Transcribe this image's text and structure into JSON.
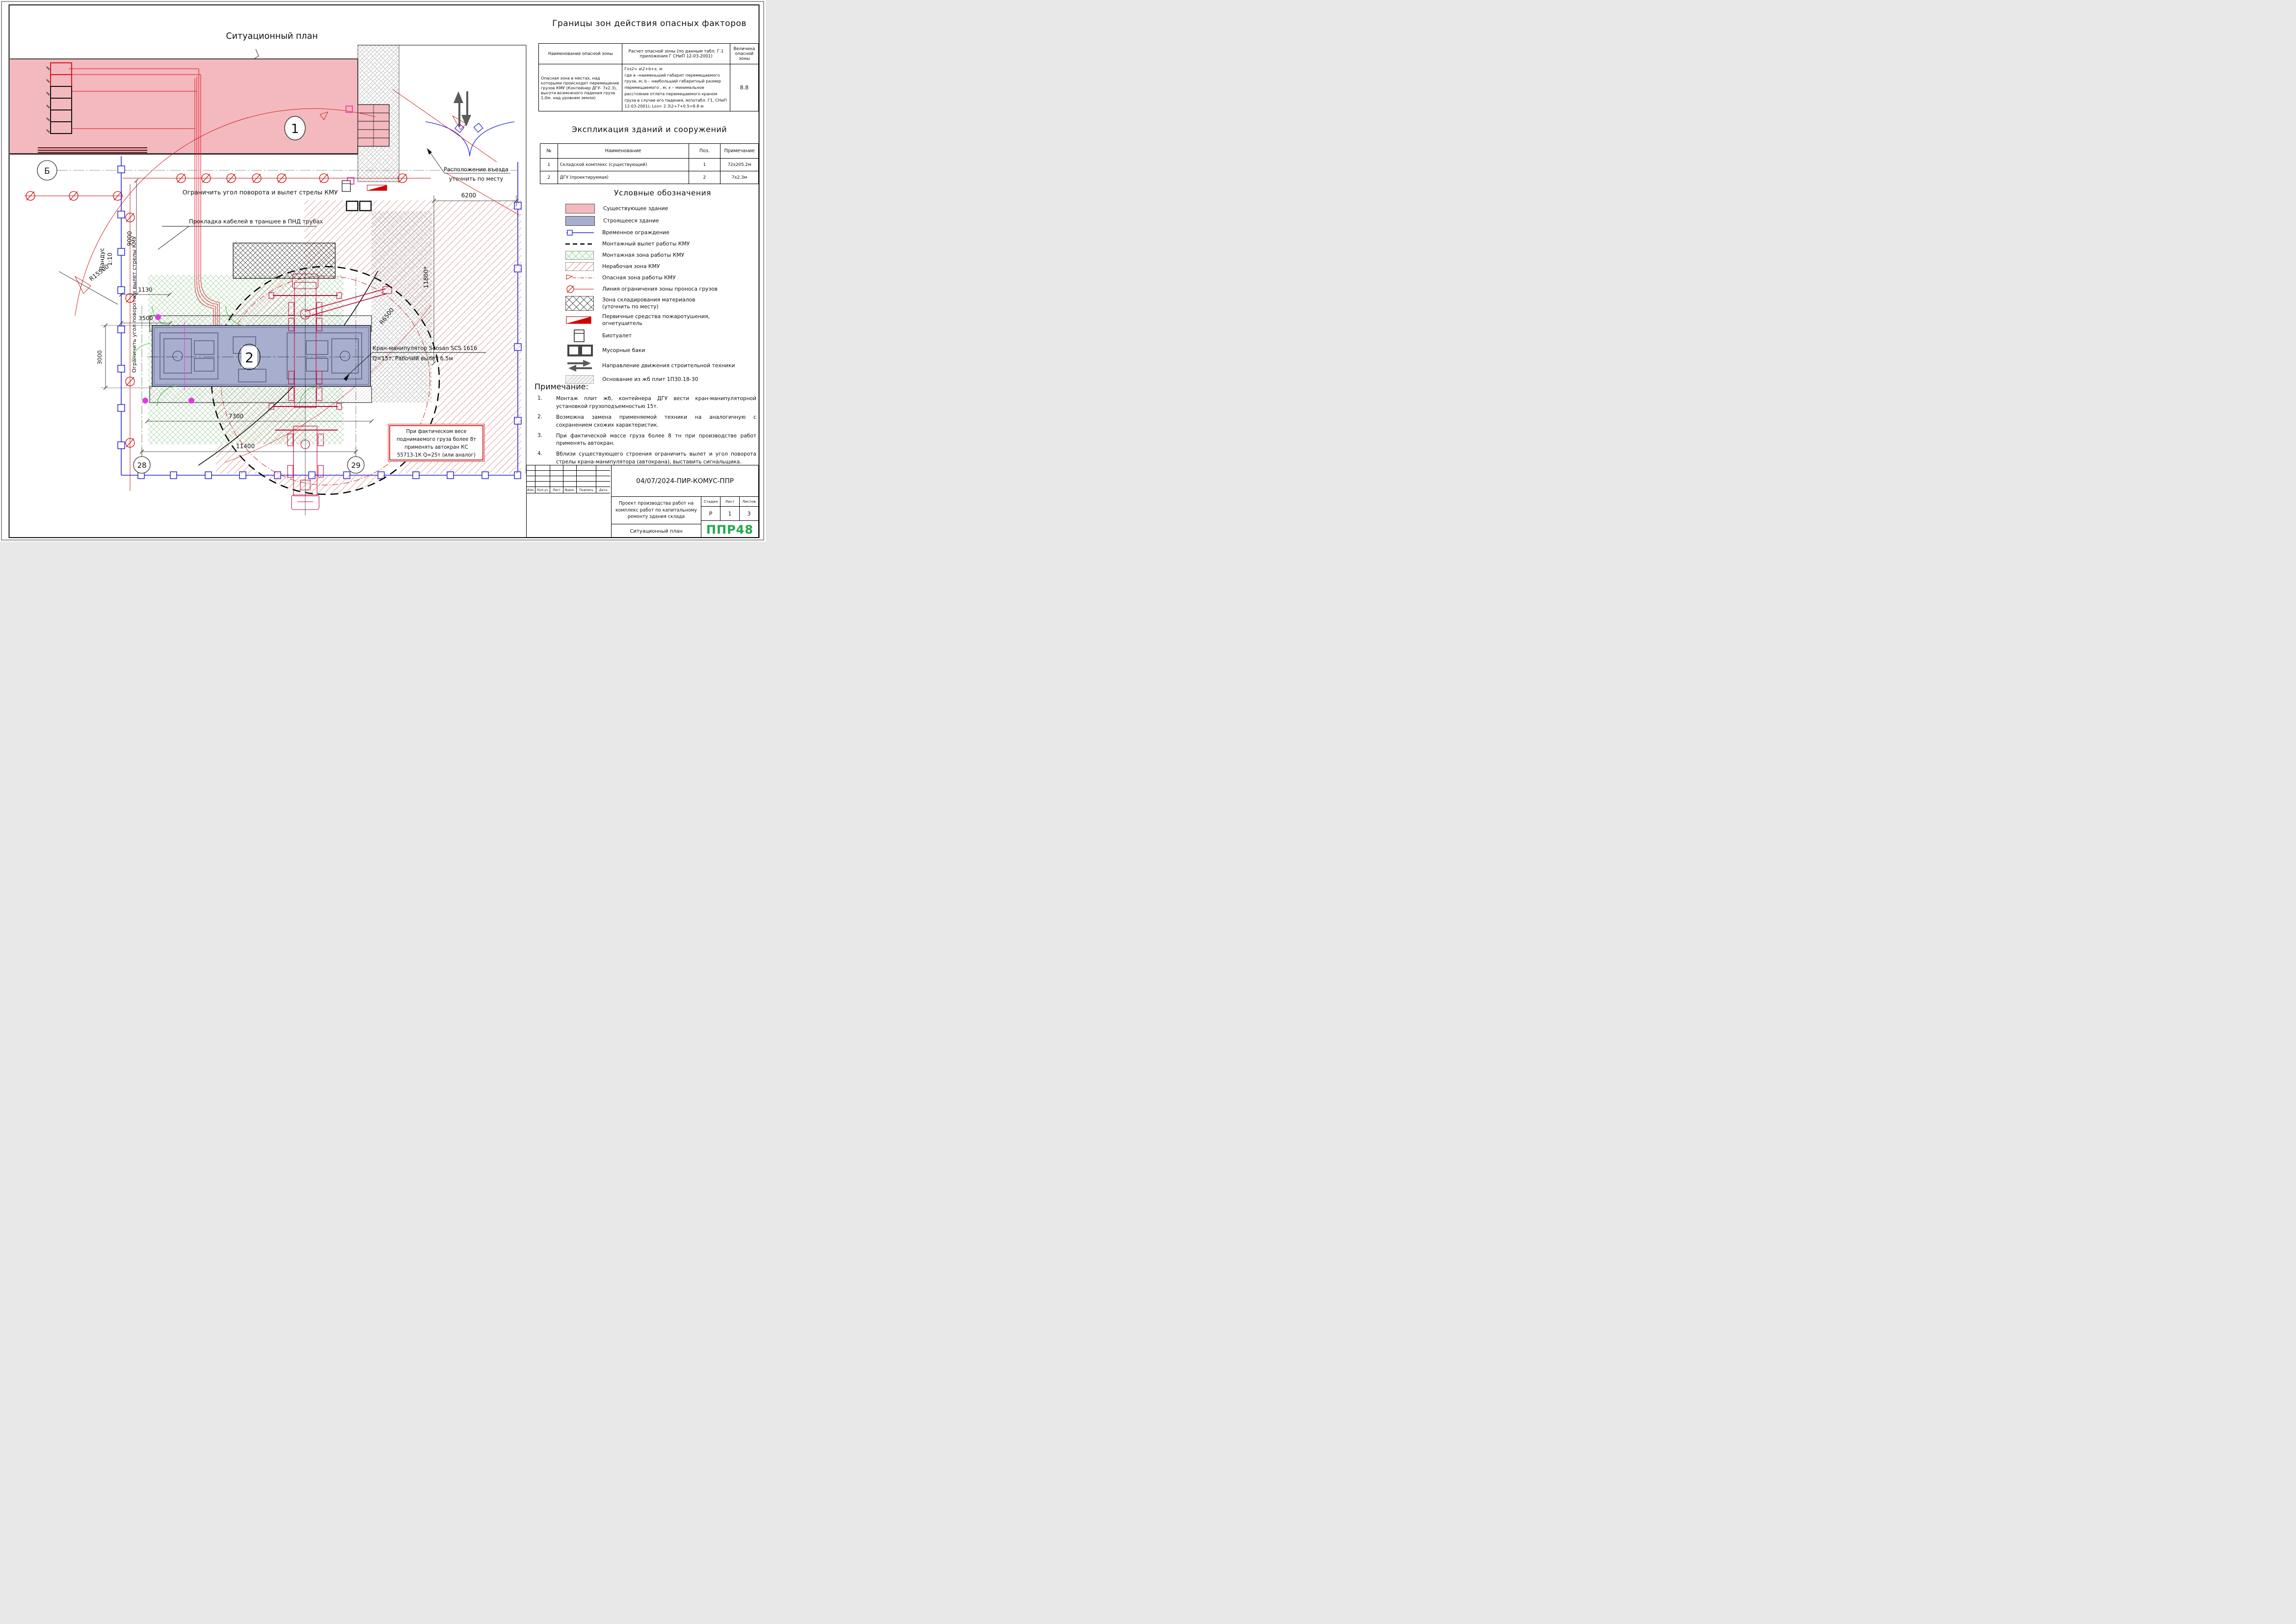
{
  "plan": {
    "title": "Ситуационный план",
    "labels": {
      "limit_red": "Ограничить угол поворота и вылет стрелы КМУ",
      "cable": "Прокладка кабелей в траншее в ПНД трубах",
      "entrance_line1": "Расположение въезда",
      "entrance_line2": "уточнить по месту",
      "crane_name": "Кран-манипулятор Soosan SCS 1616",
      "crane_spec": "Q=15т. Рабочий вылет 6.5м",
      "ramp_line1": "Пандус",
      "ramp_line2": "1:10"
    },
    "warning_box": {
      "lines": [
        "При    фактическом    весе",
        "поднимаемого груза более 8т",
        "применять   автокран   КС",
        "55713-1К Q=25т (или аналог)"
      ]
    },
    "dims": {
      "d6200": "6200",
      "d9000": "9000",
      "d1130": "1130",
      "d3500": "3500",
      "d3000": "3000",
      "d7300": "7300",
      "d11400": "11400",
      "d11800": "11800*",
      "r15500": "R15500",
      "r6500": "R6500"
    },
    "axes": {
      "axis_b": "Б",
      "axis_28": "28",
      "axis_29": "29"
    },
    "positions": {
      "pos1": "1",
      "pos2": "2"
    }
  },
  "hazard_table": {
    "title": "Границы зон действия опасных факторов",
    "headers": [
      "Наименование опасной зоны",
      "Расчет опасной зоны (по данным табл. Г.1 приложения Г СНиП 12-03-2001)",
      "Величина опасной зоны"
    ],
    "row": {
      "name": "Опасная зона в местах, над которыми происходит перемещение грузов КМУ (Контейнер ДГУ- 7х2.3), высота возможного падения груза 1,0м. над уровнем земли)",
      "calc": "Гоз2= а\\2+b+х, м\nгде а –наименьший габарит перемещаемого груза, м; b – наибольший габаритный размер перемещаемого , м; х – минимальное расстояние отлета перемещаемого краном груза в случае его падения, м(потабл. Г1, СНиП 12-03-2001); Lоз= 2.3\\2+7+0.5=8.8 м",
      "value": "8.8"
    }
  },
  "explication_table": {
    "title": "Экспликация зданий и сооружений",
    "headers": [
      "№",
      "Наименование",
      "Поз.",
      "Примечание"
    ],
    "rows": [
      [
        "1",
        "Складской комплекс (существующий)",
        "1",
        "72х205.2м"
      ],
      [
        "2",
        "ДГУ (проектируемая)",
        "2",
        "7х2.3м"
      ]
    ]
  },
  "legend": {
    "title": "Условные обозначения",
    "items": [
      {
        "label": "Существующее здание"
      },
      {
        "label": "Строящееся здание"
      },
      {
        "label": "Временное ограждение"
      },
      {
        "label": "Монтажный вылет работы КМУ"
      },
      {
        "label": "Монтажная зона работы КМУ"
      },
      {
        "label": "Нерабочая зона КМУ"
      },
      {
        "label": "Опасная зона работы КМУ"
      },
      {
        "label": "Линия ограничения зоны проноса грузов"
      },
      {
        "label": "Зона складирования материалов\n(уточнить по месту)"
      },
      {
        "label": "Первичные средства пожаротушения,\nогнетушитель"
      },
      {
        "label": "Биотуалет"
      },
      {
        "label": "Мусорные баки"
      },
      {
        "label": "Направление движения строительной техники"
      },
      {
        "label": "Основание из жб плит 1П30.18-30"
      }
    ]
  },
  "notes": {
    "heading": "Примечание:",
    "items": [
      {
        "num": "1.",
        "text": "Монтаж плит жб, контейнера ДГУ вести кран-манипуляторной установкой грузоподъемностью 15т."
      },
      {
        "num": "2.",
        "text": "Возможна замена применяемой техники на аналогичную с сохранением схожих характеристик."
      },
      {
        "num": "3.",
        "text": "При фактической массе груза более 8 тн при производстве работ применять автокран."
      },
      {
        "num": "4.",
        "text": "Вблизи существующего строения ограничить вылет и угол поворота стрелы крана-манипулятора (автокрана), выставить сигнальщика."
      }
    ]
  },
  "title_block": {
    "doc_number": "04/07/2024-ПИР-КОМУС-ППР",
    "stamp_cols": [
      "Изм.",
      "Кол.уч",
      "Лист",
      "№док.",
      "Подпись",
      "Дата"
    ],
    "project": "Проект производства работ на комплекс работ по капитальному ремонту здания склада",
    "doc_title": "Ситуационный план",
    "stage_headers": [
      "Стадия",
      "Лист",
      "Листов"
    ],
    "stage": "Р",
    "sheet_num": "1",
    "sheets_total": "3",
    "logo": "ППР48"
  },
  "colors": {
    "existing_building": "#f3b9be",
    "under_construction": "#a8aecd",
    "fence_blue": "#2a2ad0",
    "danger_red": "#cc1111",
    "crane_red": "#c00a38",
    "green": "#2ebf2e",
    "magenta": "#e23ae2",
    "logo_green": "#1fa84c"
  }
}
